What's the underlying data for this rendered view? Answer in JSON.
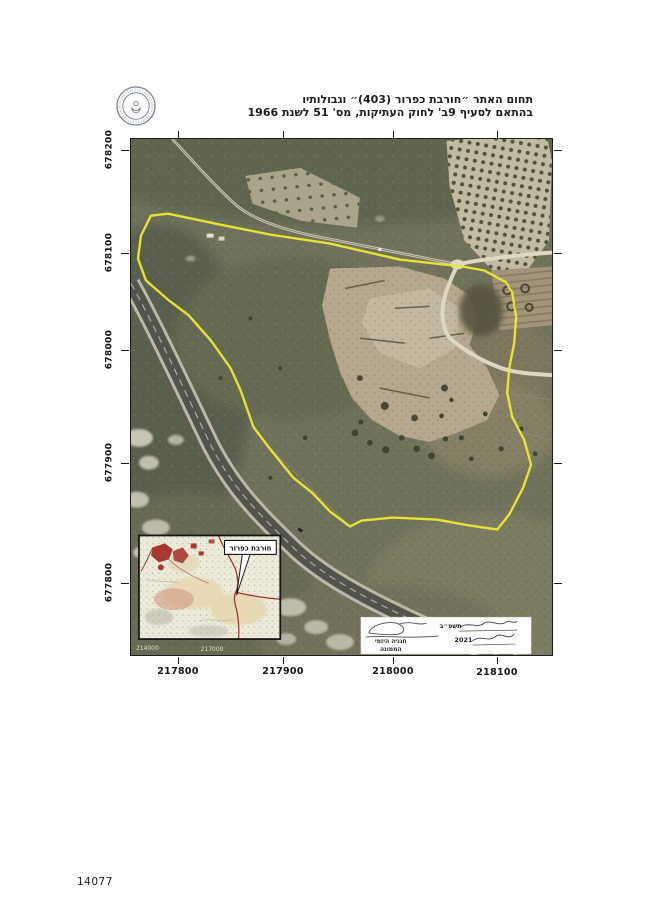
{
  "page": {
    "number": "14077"
  },
  "header": {
    "title_line1": "תחום האתר ״חורבת כפרור (403)״ וגבולותיו",
    "title_line2": "בהתאם לסעיף 9ב' לחוק העתיקות, מס' 51 לשנת 1966"
  },
  "map": {
    "boundary_color": "#ede832",
    "axis": {
      "northing_labels": [
        "678200",
        "678100",
        "678000",
        "677900",
        "677800"
      ],
      "easting_labels": [
        "217800",
        "217900",
        "218000",
        "218100"
      ]
    },
    "inset": {
      "callout_label": "חורבת כפרור",
      "grid_labels": [
        "214000",
        "217000"
      ]
    },
    "signature_box": {
      "hebrew_year_label": "תשפ״ב",
      "gregorian_year_label": "2021",
      "signer_name": "חנניה היזמי",
      "signer_title": "הממונה"
    }
  }
}
